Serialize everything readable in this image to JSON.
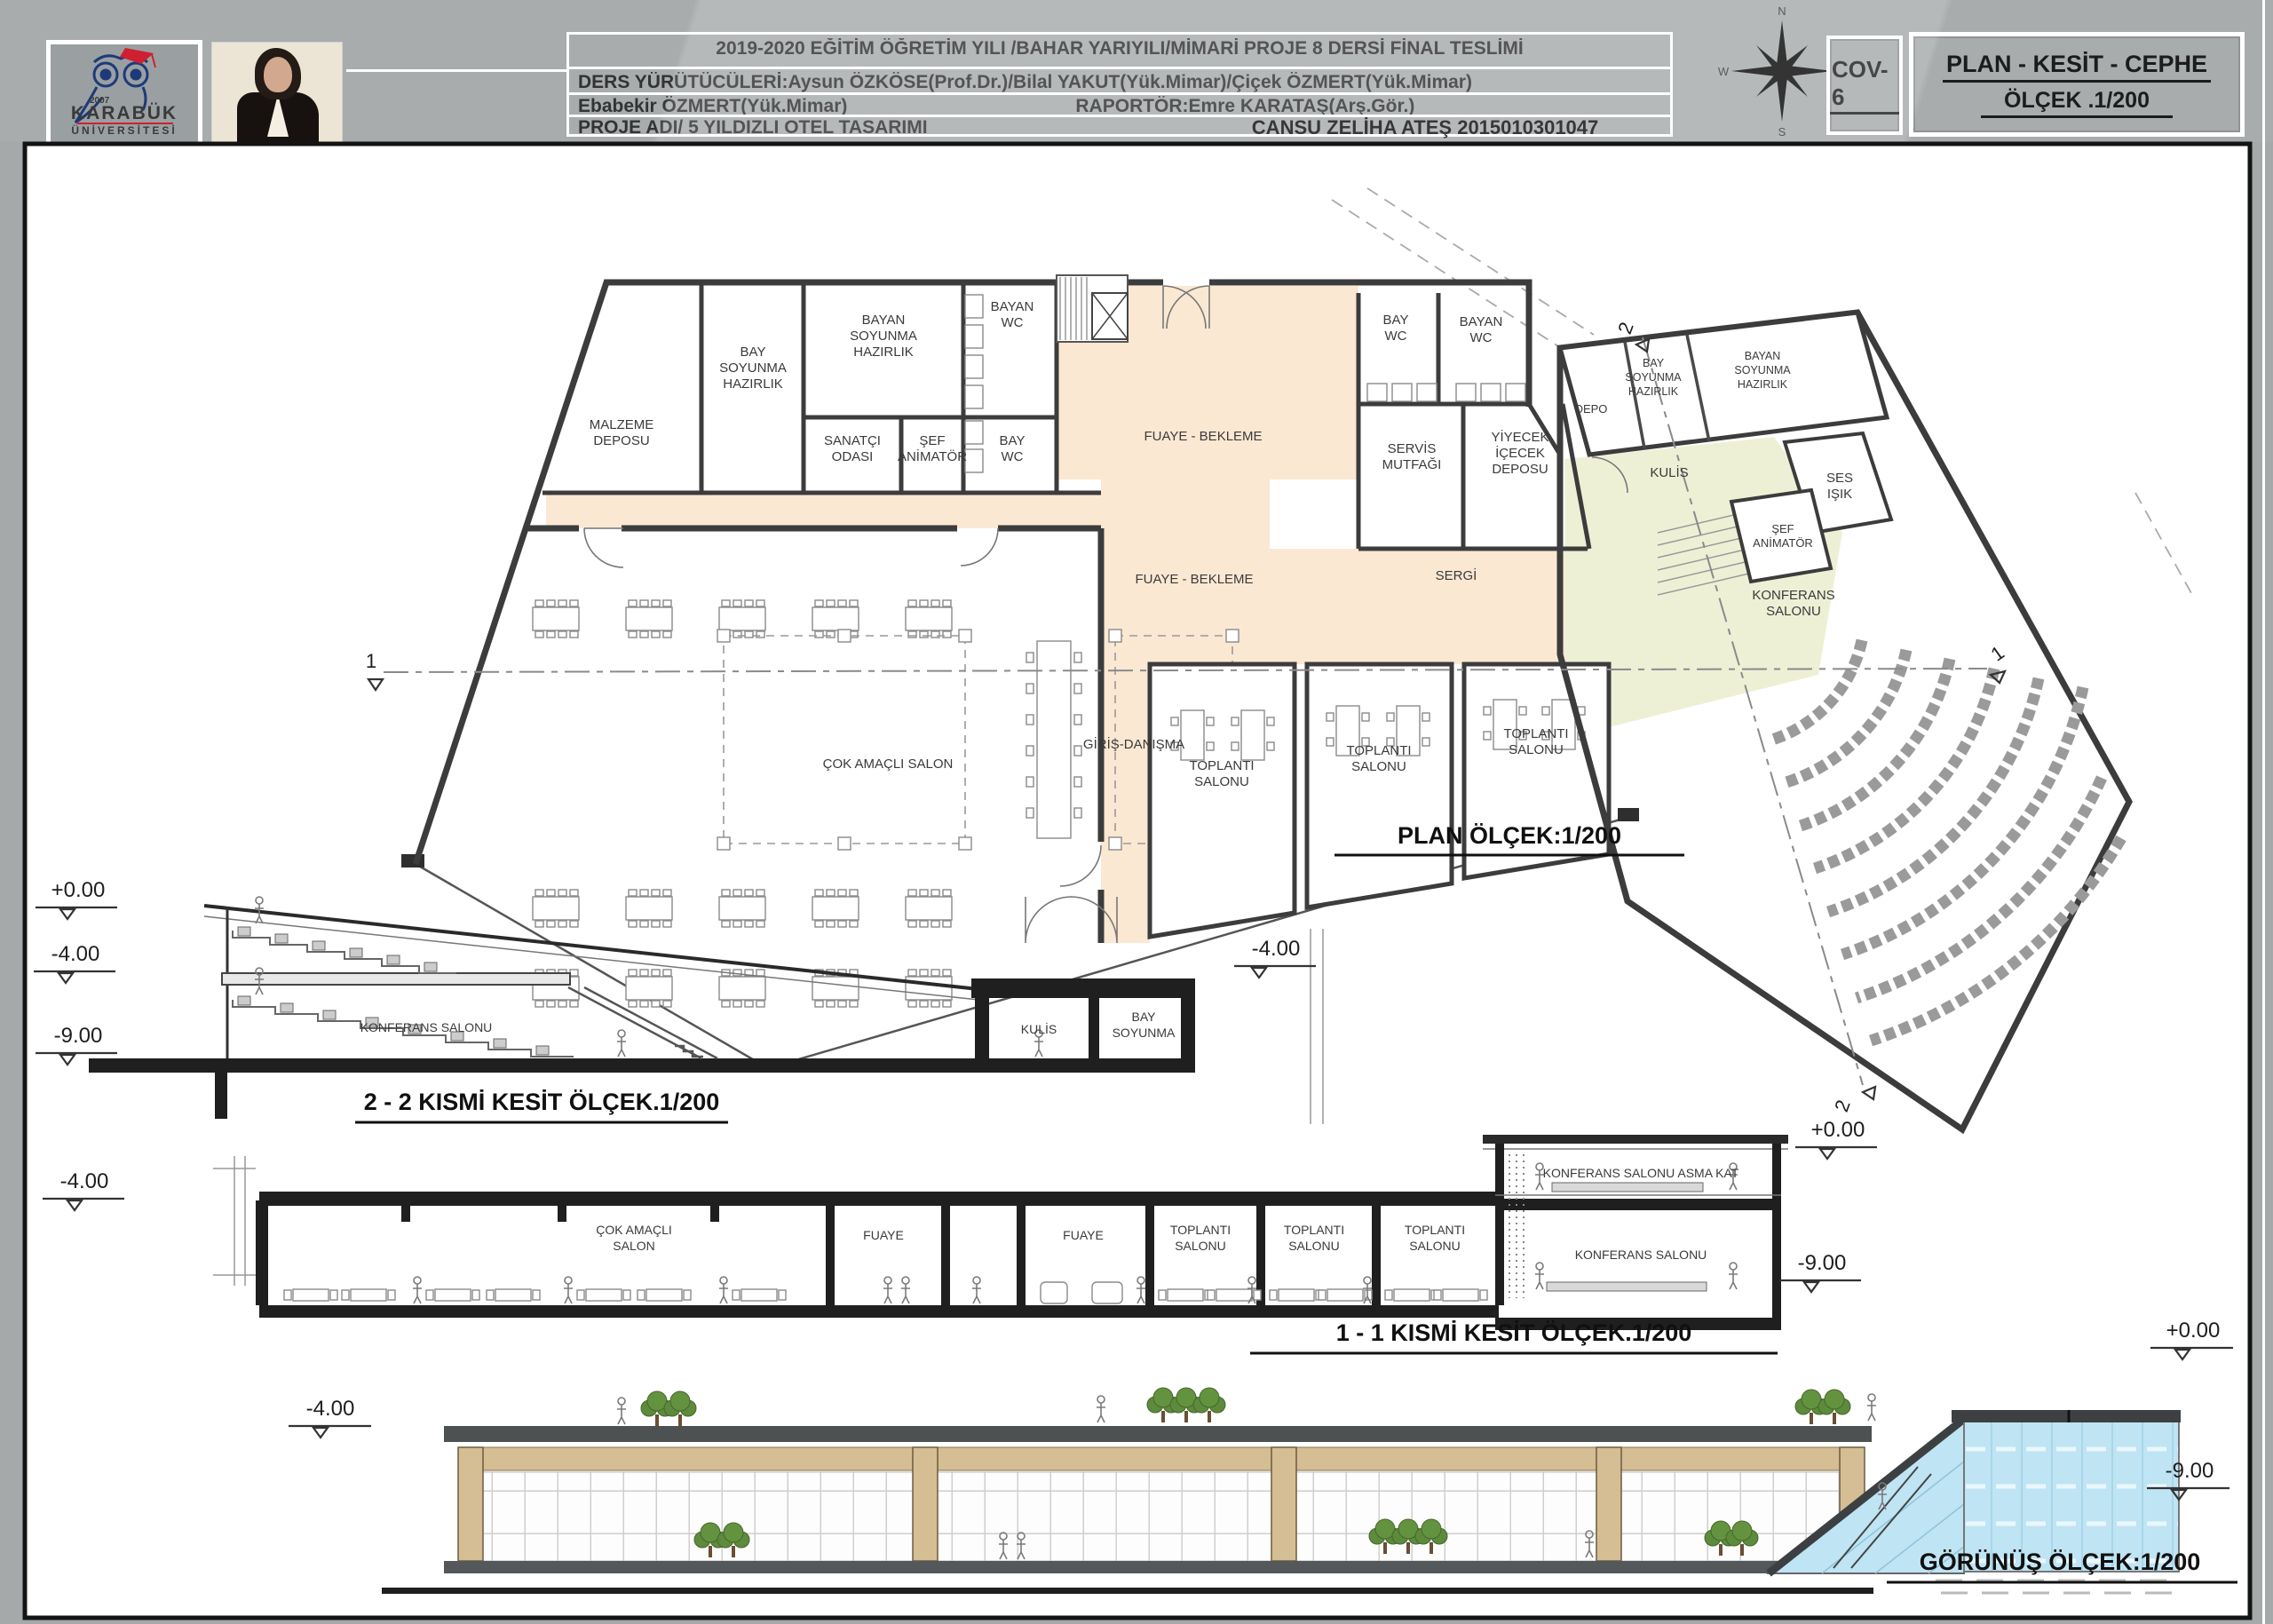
{
  "header": {
    "line1": "2019-2020 EĞİTİM ÖĞRETİM YILI /BAHAR YARIYILI/MİMARİ PROJE 8 DERSİ FİNAL TESLİMİ",
    "line2": "DERS YÜRÜTÜCÜLERİ:Aysun ÖZKÖSE(Prof.Dr.)/Bilal YAKUT(Yük.Mimar)/Çiçek ÖZMERT(Yük.Mimar)",
    "line3a": "Ebabekir ÖZMERT(Yük.Mimar)",
    "line3b": "RAPORTÖR:Emre KARATAŞ(Arş.Gör.)",
    "line4": "PROJE ADI/ 5 YILDIZLI OTEL TASARIMI",
    "student": "CANSU ZELİHA ATEŞ  2015010301047",
    "sheet_code": "COV-6",
    "sheet_title1": "PLAN - KESİT - CEPHE",
    "sheet_title2": "ÖLÇEK .1/200"
  },
  "logo": {
    "university1": "KARABÜK",
    "university2": "ÜNİVERSİTESİ",
    "year": "2007"
  },
  "compass": {
    "n": "N",
    "s": "S",
    "w": "W",
    "o": "O"
  },
  "levels": {
    "zero": "+0.00",
    "m4": "-4.00",
    "m9": "-9.00"
  },
  "plan": {
    "title": "PLAN ÖLÇEK:1/200",
    "marker1": "1",
    "marker2": "2",
    "malzeme": [
      "MALZEME",
      "DEPOSU"
    ],
    "bay_soyunma": [
      "BAY",
      "SOYUNMA",
      "HAZIRLIK"
    ],
    "bayan_soyunma": [
      "BAYAN",
      "SOYUNMA",
      "HAZIRLIK"
    ],
    "bay_wc": [
      "BAY",
      "WC"
    ],
    "bayan_wc": [
      "BAYAN",
      "WC"
    ],
    "sanatci": [
      "SANATÇI",
      "ODASI"
    ],
    "sef_animator": [
      "ŞEF",
      "ANİMATÖR"
    ],
    "fuaye": "FUAYE - BEKLEME",
    "sergi": "SERGİ",
    "servis": [
      "SERVİS",
      "MUTFAĞI"
    ],
    "yiyecek": [
      "YİYECEK",
      "İÇECEK",
      "DEPOSU"
    ],
    "depo": "DEPO",
    "kulis": "KULİS",
    "ses_isik": [
      "SES",
      "IŞIK"
    ],
    "konferans": [
      "KONFERANS",
      "SALONU"
    ],
    "cok_amacli": "ÇOK AMAÇLI SALON",
    "giris": "GİRİŞ-DANIŞMA",
    "toplanti": [
      "TOPLANTI",
      "SALONU"
    ]
  },
  "section2": {
    "title": "2 - 2 KISMİ KESİT ÖLÇEK.1/200",
    "konferans": "KONFERANS SALONU",
    "kulis": "KULİS",
    "bay_soyunma": [
      "BAY",
      "SOYUNMA"
    ]
  },
  "section1": {
    "title": "1 - 1 KISMİ KESİT ÖLÇEK.1/200",
    "cok_amacli": [
      "ÇOK AMAÇLI",
      "SALON"
    ],
    "fuaye": "FUAYE",
    "toplanti": [
      "TOPLANTI",
      "SALONU"
    ],
    "asma_kat": "KONFERANS SALONU ASMA KAT",
    "konferans": "KONFERANS SALONU"
  },
  "elevation": {
    "title": "GÖRÜNÜŞ ÖLÇEK:1/200"
  },
  "colors": {
    "peach": "#fbe8d3",
    "kulis_green": "#eef0d6",
    "glass_blue": "#bfe4f4",
    "beige": "#d5bd94",
    "wall": "#3c3c3c"
  }
}
